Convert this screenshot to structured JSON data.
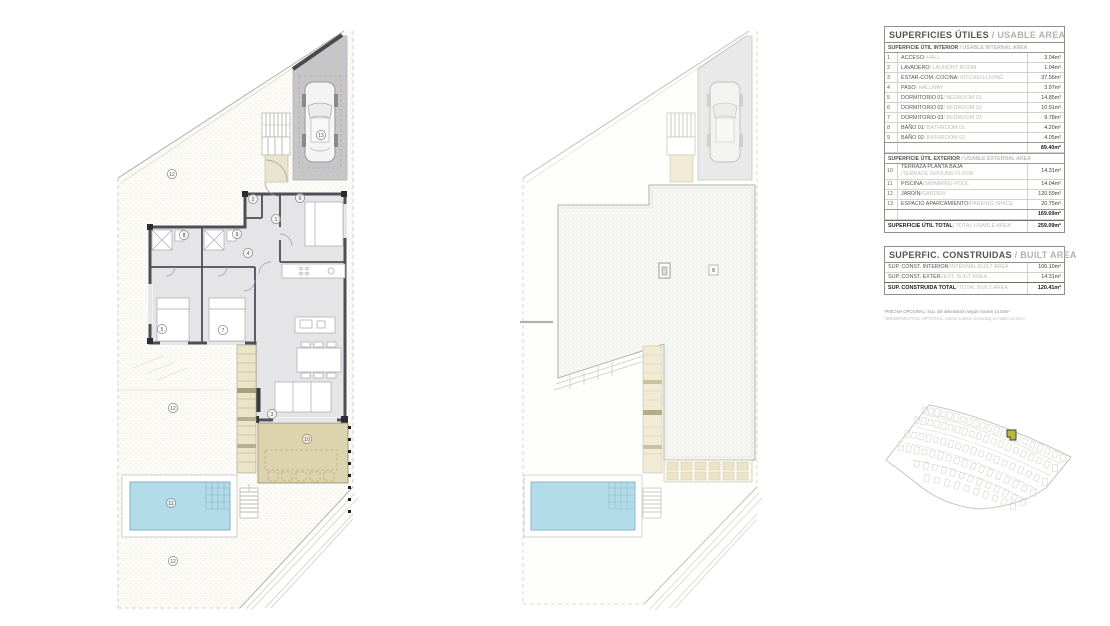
{
  "usable_table": {
    "title_es": "SUPERFICIES ÚTILES",
    "title_en": " / USABLE AREA",
    "interior_header_es": "SUPERFICIE ÚTIL INTERIOR",
    "interior_header_en": " / USABLE INTERNAL AREA",
    "interior_rows": [
      {
        "num": "1",
        "es": "ACCESO",
        "en": "/ HALL",
        "value": "3.04m²"
      },
      {
        "num": "2",
        "es": "LAVADERO",
        "en": "/ LAUNDRY ROOM",
        "value": "1.04m²"
      },
      {
        "num": "3",
        "es": "ESTAR-COM.-COCINA",
        "en": "/ KITCHEN-LIVING",
        "value": "37.56m²"
      },
      {
        "num": "4",
        "es": "PASO",
        "en": "/ HALLWAY",
        "value": "3.97m²"
      },
      {
        "num": "5",
        "es": "DORMITORIO 01",
        "en": "/ BEDROOM 01",
        "value": "14.85m²"
      },
      {
        "num": "6",
        "es": "DORMITORIO 02",
        "en": "/ BEDROOM 02",
        "value": "10.91m²"
      },
      {
        "num": "7",
        "es": "DORMITORIO 03",
        "en": "/ BEDROOM 03",
        "value": "9.78m²"
      },
      {
        "num": "8",
        "es": "BAÑO 01",
        "en": "/ BATHROOM 01",
        "value": "4.20m²"
      },
      {
        "num": "9",
        "es": "BAÑO 02",
        "en": "/ BATHROOM 02",
        "value": "4.05m²"
      }
    ],
    "interior_total": "89.40m²",
    "exterior_header_es": "SUPERFICIE ÚTIL EXTERIOR",
    "exterior_header_en": " / USABLE EXTERNAL AREA",
    "exterior_rows": [
      {
        "num": "10",
        "es": "TERRAZA PLANTA BAJA",
        "en": "/TERRACE GROUND FLOOR",
        "value": "14.31m²",
        "stack": true
      },
      {
        "num": "11",
        "es": "PISCINA",
        "en": "/SWIMMING POOL",
        "value": "14.04m²"
      },
      {
        "num": "12",
        "es": "JARDÍN",
        "en": "/GARDEN",
        "value": "120.59m²"
      },
      {
        "num": "13",
        "es": "ESPACIO APARCAMIENTO",
        "en": "/PARKING SPACE",
        "value": "20.75m²"
      }
    ],
    "exterior_total": "169.69m²",
    "total_label_es": "SUPERFICIE ÚTIL TOTAL",
    "total_label_en": " / TOTAL USABLE AREA",
    "total_value": "259.09m²"
  },
  "built_table": {
    "title_es": "SUPERFIC. CONSTRUIDAS",
    "title_en": " / BUILT AREA",
    "rows": [
      {
        "es": "SUP. CONST. INTERIOR",
        "en": " /INTERNAL BUILT AREA",
        "value": "106.10m²"
      },
      {
        "es": "SUP. CONST. EXTER.",
        "en": " /EXT. BUILT AREA",
        "value": "14.31m²"
      }
    ],
    "total_label_es": "SUP. CONSTRUIDA TOTAL",
    "total_label_en": " / TOTAL BUILT AREA",
    "total_value": "120.41m²"
  },
  "footnotes": {
    "line1": "*PISCINA OPCIONAL: Sup. útil delimitación según modelo 14.04m²",
    "line2": "*SWIMMING POOL OPTIONAL: Useful surface according to model 14.04m²"
  },
  "floor_plan_labels": [
    {
      "text": "13",
      "x": 216,
      "y": 113
    },
    {
      "text": "12",
      "x": 67,
      "y": 152
    },
    {
      "text": "2",
      "x": 148,
      "y": 177
    },
    {
      "text": "6",
      "x": 195,
      "y": 176
    },
    {
      "text": "1",
      "x": 171,
      "y": 197
    },
    {
      "text": "8",
      "x": 79,
      "y": 213
    },
    {
      "text": "9",
      "x": 132,
      "y": 212
    },
    {
      "text": "4",
      "x": 143,
      "y": 231
    },
    {
      "text": "5",
      "x": 57,
      "y": 307
    },
    {
      "text": "7",
      "x": 118,
      "y": 308
    },
    {
      "text": "3",
      "x": 167,
      "y": 392
    },
    {
      "text": "10",
      "x": 202,
      "y": 417
    },
    {
      "text": "12",
      "x": 68,
      "y": 386
    },
    {
      "text": "11",
      "x": 66,
      "y": 481
    },
    {
      "text": "12",
      "x": 68,
      "y": 539
    }
  ],
  "colors": {
    "wall": "#4e4e56",
    "floor": "#e5e5e7",
    "garage": "#c6c6c8",
    "terrace": "#ddd3ae",
    "steps": "#ece4c8",
    "pool": "#b3dcea",
    "highlight_plot": "#b6b944"
  }
}
